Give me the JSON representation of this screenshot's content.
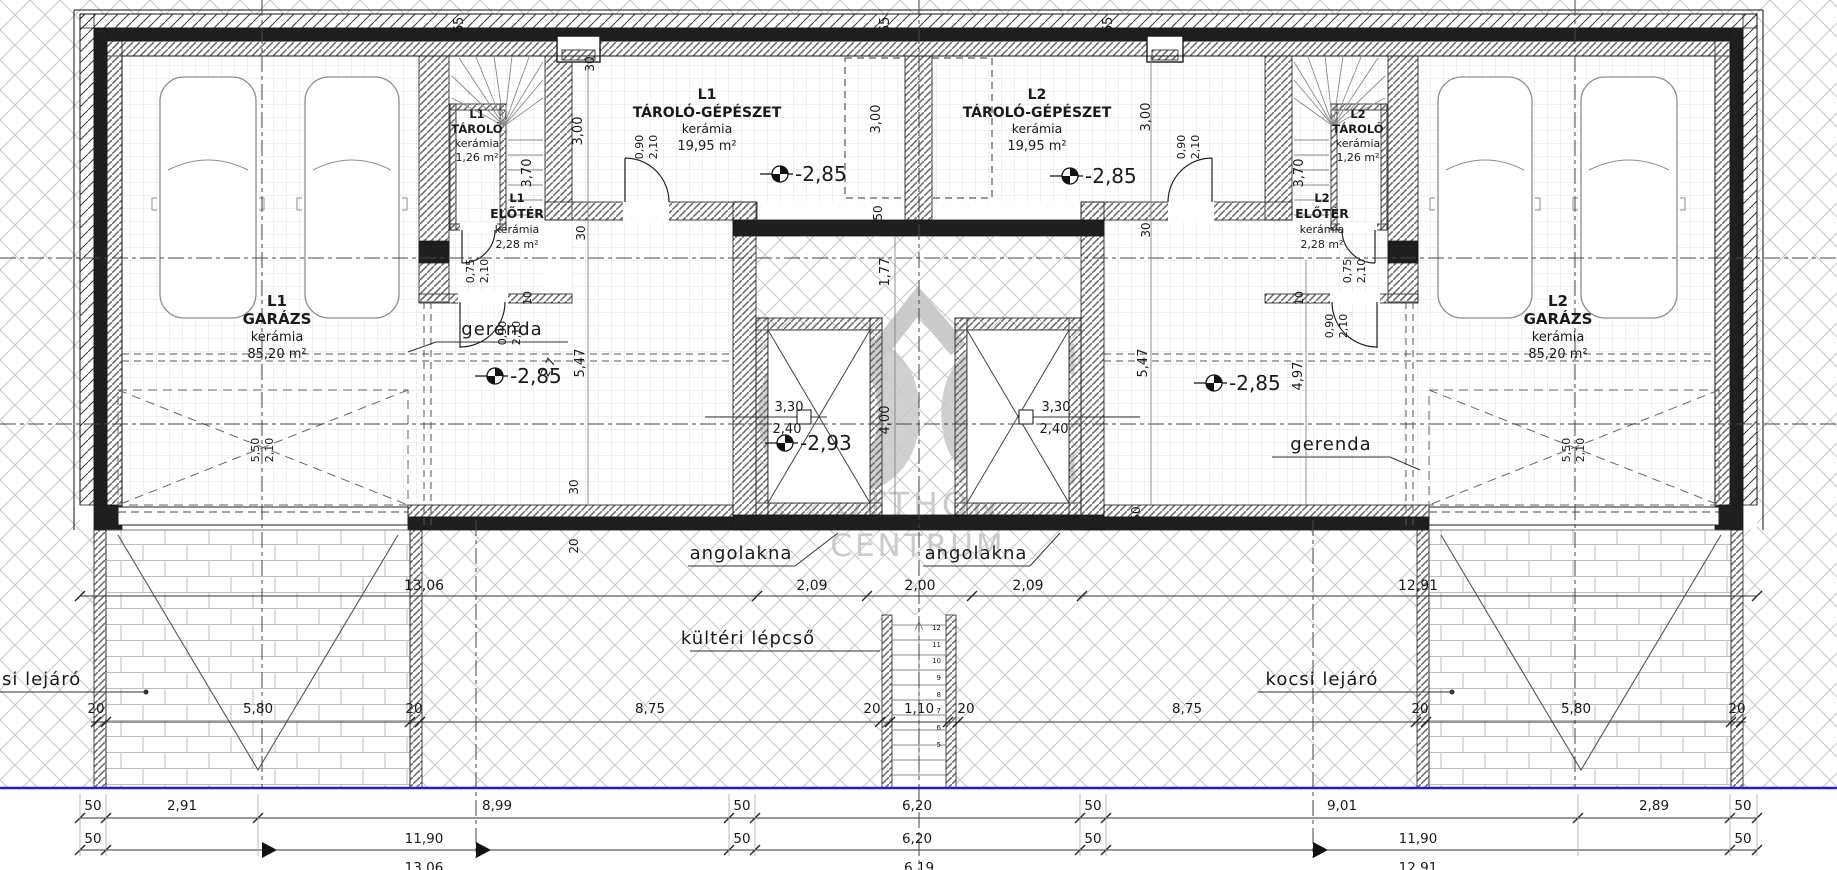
{
  "watermark": {
    "monogram": "OC",
    "word1": "OTTHON",
    "word2": "CENTRUM"
  },
  "texts": [
    {
      "n": "room-l1-garage-code",
      "t": "L1",
      "x": 277,
      "y": 306,
      "s": 15,
      "b": 1
    },
    {
      "n": "room-l1-garage-name",
      "t": "GARÁZS",
      "x": 277,
      "y": 324,
      "s": 15,
      "b": 1
    },
    {
      "n": "room-l1-garage-finish",
      "t": "kerámia",
      "x": 277,
      "y": 341,
      "s": 13
    },
    {
      "n": "room-l1-garage-area",
      "t": "85,20 m²",
      "x": 277,
      "y": 358,
      "s": 13
    },
    {
      "n": "room-l2-garage-code",
      "t": "L2",
      "x": 1558,
      "y": 306,
      "s": 15,
      "b": 1
    },
    {
      "n": "room-l2-garage-name",
      "t": "GARÁZS",
      "x": 1558,
      "y": 324,
      "s": 15,
      "b": 1
    },
    {
      "n": "room-l2-garage-finish",
      "t": "kerámia",
      "x": 1558,
      "y": 341,
      "s": 13
    },
    {
      "n": "room-l2-garage-area",
      "t": "85,20 m²",
      "x": 1558,
      "y": 358,
      "s": 13
    },
    {
      "n": "room-l1-mech-code",
      "t": "L1",
      "x": 707,
      "y": 99,
      "s": 14,
      "b": 1
    },
    {
      "n": "room-l1-mech-name",
      "t": "TÁROLÓ-GÉPÉSZET",
      "x": 707,
      "y": 117,
      "s": 14,
      "b": 1
    },
    {
      "n": "room-l1-mech-finish",
      "t": "kerámia",
      "x": 707,
      "y": 133,
      "s": 12.5
    },
    {
      "n": "room-l1-mech-area",
      "t": "19,95 m²",
      "x": 707,
      "y": 150,
      "s": 13
    },
    {
      "n": "room-l2-mech-code",
      "t": "L2",
      "x": 1037,
      "y": 99,
      "s": 14,
      "b": 1
    },
    {
      "n": "room-l2-mech-name",
      "t": "TÁROLÓ-GÉPÉSZET",
      "x": 1037,
      "y": 117,
      "s": 14,
      "b": 1
    },
    {
      "n": "room-l2-mech-finish",
      "t": "kerámia",
      "x": 1037,
      "y": 133,
      "s": 12.5
    },
    {
      "n": "room-l2-mech-area",
      "t": "19,95 m²",
      "x": 1037,
      "y": 150,
      "s": 13
    },
    {
      "n": "room-l1-storage-code",
      "t": "L1",
      "x": 477,
      "y": 118,
      "s": 11.5,
      "b": 1
    },
    {
      "n": "room-l1-storage-name",
      "t": "TÁROLÓ",
      "x": 477,
      "y": 133,
      "s": 11.5,
      "b": 1
    },
    {
      "n": "room-l1-storage-finish",
      "t": "kerámia",
      "x": 477,
      "y": 147,
      "s": 11
    },
    {
      "n": "room-l1-storage-area",
      "t": "1,26 m²",
      "x": 477,
      "y": 161,
      "s": 11
    },
    {
      "n": "room-l1-hall-code",
      "t": "L1",
      "x": 517,
      "y": 202,
      "s": 11.5,
      "b": 1
    },
    {
      "n": "room-l1-hall-name",
      "t": "ELŐTÉR",
      "x": 517,
      "y": 218,
      "s": 12.5,
      "b": 1
    },
    {
      "n": "room-l1-hall-finish",
      "t": "kerámia",
      "x": 517,
      "y": 233,
      "s": 11
    },
    {
      "n": "room-l1-hall-area",
      "t": "2,28 m²",
      "x": 517,
      "y": 248,
      "s": 11
    },
    {
      "n": "room-l2-storage-code",
      "t": "L2",
      "x": 1358,
      "y": 118,
      "s": 11.5,
      "b": 1
    },
    {
      "n": "room-l2-storage-name",
      "t": "TÁROLÓ",
      "x": 1358,
      "y": 133,
      "s": 11.5,
      "b": 1
    },
    {
      "n": "room-l2-storage-finish",
      "t": "kerámia",
      "x": 1358,
      "y": 147,
      "s": 11
    },
    {
      "n": "room-l2-storage-area",
      "t": "1,26 m²",
      "x": 1358,
      "y": 161,
      "s": 11
    },
    {
      "n": "room-l2-hall-code",
      "t": "L2",
      "x": 1322,
      "y": 202,
      "s": 11.5,
      "b": 1
    },
    {
      "n": "room-l2-hall-name",
      "t": "ELŐTÉR",
      "x": 1322,
      "y": 218,
      "s": 12.5,
      "b": 1
    },
    {
      "n": "room-l2-hall-finish",
      "t": "kerámia",
      "x": 1322,
      "y": 233,
      "s": 11
    },
    {
      "n": "room-l2-hall-area",
      "t": "2,28 m²",
      "x": 1322,
      "y": 248,
      "s": 11
    },
    {
      "n": "level-l1-mech",
      "t": "-2,85",
      "x": 795,
      "y": 181,
      "s": 20,
      "a": "s"
    },
    {
      "n": "level-l2-mech",
      "t": "-2,85",
      "x": 1085,
      "y": 183,
      "s": 20,
      "a": "s"
    },
    {
      "n": "level-l1-garage",
      "t": "-2,85",
      "x": 510,
      "y": 383,
      "s": 20,
      "a": "s"
    },
    {
      "n": "level-l2-garage",
      "t": "-2,85",
      "x": 1229,
      "y": 390,
      "s": 20,
      "a": "s"
    },
    {
      "n": "level-shaft",
      "t": "-2,93",
      "x": 800,
      "y": 450,
      "s": 20,
      "a": "s"
    },
    {
      "n": "note-beam-left",
      "t": "gerenda",
      "x": 502,
      "y": 335,
      "s": 18,
      "ls": 1
    },
    {
      "n": "note-beam-right",
      "t": "gerenda",
      "x": 1331,
      "y": 450,
      "s": 18,
      "ls": 1
    },
    {
      "n": "note-lightwell-left",
      "t": "angolakna",
      "x": 741,
      "y": 559,
      "s": 18,
      "ls": 1
    },
    {
      "n": "note-lightwell-right",
      "t": "angolakna",
      "x": 976,
      "y": 559,
      "s": 18,
      "ls": 1
    },
    {
      "n": "note-outdoor-stair",
      "t": "kültéri lépcső",
      "x": 748,
      "y": 644,
      "s": 18,
      "ls": 1
    },
    {
      "n": "note-car-ramp-left",
      "t": "si lejáró",
      "x": 2,
      "y": 685,
      "s": 18,
      "ls": 1,
      "a": "s"
    },
    {
      "n": "note-car-ramp-right",
      "t": "kocsi lejáró",
      "x": 1322,
      "y": 685,
      "s": 18,
      "ls": 1
    },
    {
      "n": "shaft-left-dim1",
      "t": "3,30",
      "x": 789,
      "y": 411,
      "s": 13
    },
    {
      "n": "shaft-left-dim2",
      "t": "2,40",
      "x": 787,
      "y": 433,
      "s": 13
    },
    {
      "n": "shaft-right-dim1",
      "t": "3,30",
      "x": 1056,
      "y": 411,
      "s": 13
    },
    {
      "n": "shaft-right-dim2",
      "t": "2,40",
      "x": 1054,
      "y": 433,
      "s": 13
    },
    {
      "t": "13,06",
      "x": 424,
      "y": 590,
      "s": 14
    },
    {
      "t": "2,09",
      "x": 812,
      "y": 590,
      "s": 14
    },
    {
      "t": "2,00",
      "x": 920,
      "y": 590,
      "s": 14
    },
    {
      "t": "2,09",
      "x": 1028,
      "y": 590,
      "s": 14
    },
    {
      "t": "12,91",
      "x": 1418,
      "y": 590,
      "s": 14
    },
    {
      "t": "20",
      "x": 96,
      "y": 713,
      "s": 13.5
    },
    {
      "t": "5,80",
      "x": 258,
      "y": 713,
      "s": 13.5
    },
    {
      "t": "20",
      "x": 414,
      "y": 713,
      "s": 13.5
    },
    {
      "t": "8,75",
      "x": 650,
      "y": 713,
      "s": 13.5
    },
    {
      "t": "20",
      "x": 872,
      "y": 713,
      "s": 13.5
    },
    {
      "t": "1,10",
      "x": 919,
      "y": 713,
      "s": 13.5
    },
    {
      "t": "20",
      "x": 966,
      "y": 713,
      "s": 13.5
    },
    {
      "t": "8,75",
      "x": 1187,
      "y": 713,
      "s": 13.5
    },
    {
      "t": "20",
      "x": 1420,
      "y": 713,
      "s": 13.5
    },
    {
      "t": "5,80",
      "x": 1576,
      "y": 713,
      "s": 13.5
    },
    {
      "t": "20",
      "x": 1737,
      "y": 713,
      "s": 13.5
    },
    {
      "t": "50",
      "x": 93,
      "y": 810,
      "s": 13.5
    },
    {
      "t": "2,91",
      "x": 182,
      "y": 810,
      "s": 13.5
    },
    {
      "t": "8,99",
      "x": 497,
      "y": 810,
      "s": 13.5
    },
    {
      "t": "50",
      "x": 742,
      "y": 810,
      "s": 13.5
    },
    {
      "t": "6,20",
      "x": 917,
      "y": 810,
      "s": 13.5
    },
    {
      "t": "50",
      "x": 1093,
      "y": 810,
      "s": 13.5
    },
    {
      "t": "9,01",
      "x": 1342,
      "y": 810,
      "s": 13.5
    },
    {
      "t": "2,89",
      "x": 1654,
      "y": 810,
      "s": 13.5
    },
    {
      "t": "50",
      "x": 1743,
      "y": 810,
      "s": 13.5
    },
    {
      "t": "50",
      "x": 93,
      "y": 843,
      "s": 13.5
    },
    {
      "t": "11,90",
      "x": 424,
      "y": 843,
      "s": 13.5
    },
    {
      "t": "50",
      "x": 742,
      "y": 843,
      "s": 13.5
    },
    {
      "t": "6,20",
      "x": 917,
      "y": 843,
      "s": 13.5
    },
    {
      "t": "50",
      "x": 1093,
      "y": 843,
      "s": 13.5
    },
    {
      "t": "11,90",
      "x": 1418,
      "y": 843,
      "s": 13.5
    },
    {
      "t": "50",
      "x": 1743,
      "y": 843,
      "s": 13.5
    },
    {
      "t": "13,06",
      "x": 424,
      "y": 872,
      "s": 13.5
    },
    {
      "t": "6,19",
      "x": 919,
      "y": 872,
      "s": 13.5
    },
    {
      "t": "12,91",
      "x": 1418,
      "y": 872,
      "s": 13.5
    },
    {
      "t": "65",
      "x": 463,
      "y": 25,
      "s": 13,
      "r": -90
    },
    {
      "t": "65",
      "x": 889,
      "y": 25,
      "s": 13,
      "r": -90
    },
    {
      "t": "65",
      "x": 1112,
      "y": 25,
      "s": 13,
      "r": -90
    },
    {
      "t": "30",
      "x": 594,
      "y": 64,
      "s": 12,
      "r": -90
    },
    {
      "t": "30",
      "x": 585,
      "y": 233,
      "s": 12,
      "r": -90
    },
    {
      "t": "30",
      "x": 1150,
      "y": 230,
      "s": 12,
      "r": -90
    },
    {
      "t": "30",
      "x": 578,
      "y": 487,
      "s": 12,
      "r": -90
    },
    {
      "t": "3,00",
      "x": 582,
      "y": 131,
      "s": 13,
      "r": -90
    },
    {
      "t": "3,00",
      "x": 880,
      "y": 119,
      "s": 13,
      "r": -90
    },
    {
      "t": "3,00",
      "x": 1150,
      "y": 117,
      "s": 13,
      "r": -90
    },
    {
      "t": "3,70",
      "x": 531,
      "y": 173,
      "s": 13,
      "r": -90
    },
    {
      "t": "3,70",
      "x": 1303,
      "y": 173,
      "s": 13,
      "r": -90
    },
    {
      "t": "50",
      "x": 882,
      "y": 213,
      "s": 12,
      "r": -90
    },
    {
      "t": "50",
      "x": 1140,
      "y": 514,
      "s": 12,
      "r": -90
    },
    {
      "t": "20",
      "x": 578,
      "y": 546,
      "s": 12,
      "r": -90
    },
    {
      "t": "10",
      "x": 531,
      "y": 298,
      "s": 11,
      "r": -90
    },
    {
      "t": "10",
      "x": 1303,
      "y": 298,
      "s": 11,
      "r": -90
    },
    {
      "t": "1,77",
      "x": 889,
      "y": 272,
      "s": 13,
      "r": -90
    },
    {
      "t": "4,00",
      "x": 889,
      "y": 420,
      "s": 13,
      "r": -90
    },
    {
      "t": "5,47",
      "x": 584,
      "y": 363,
      "s": 13,
      "r": -90
    },
    {
      "t": "5,47",
      "x": 1147,
      "y": 363,
      "s": 13,
      "r": -90
    },
    {
      "t": "4,97",
      "x": 1302,
      "y": 376,
      "s": 13,
      "r": -90
    },
    {
      "t": "2,7",
      "x": 552,
      "y": 369,
      "s": 12,
      "r": -65
    },
    {
      "t": "0,90",
      "x": 643,
      "y": 147,
      "s": 11,
      "r": -90
    },
    {
      "t": "2,10",
      "x": 657,
      "y": 147,
      "s": 11,
      "r": -90
    },
    {
      "t": "0,90",
      "x": 1185,
      "y": 147,
      "s": 11,
      "r": -90
    },
    {
      "t": "2,10",
      "x": 1199,
      "y": 147,
      "s": 11,
      "r": -90
    },
    {
      "t": "0,90",
      "x": 506,
      "y": 333,
      "s": 11,
      "r": -90
    },
    {
      "t": "2,10",
      "x": 520,
      "y": 333,
      "s": 11,
      "r": -90
    },
    {
      "t": "0,90",
      "x": 1333,
      "y": 326,
      "s": 11,
      "r": -90
    },
    {
      "t": "2,10",
      "x": 1347,
      "y": 326,
      "s": 11,
      "r": -90
    },
    {
      "t": "0,75",
      "x": 474,
      "y": 271,
      "s": 11,
      "r": -90
    },
    {
      "t": "2,10",
      "x": 488,
      "y": 271,
      "s": 11,
      "r": -90
    },
    {
      "t": "0,75",
      "x": 1351,
      "y": 271,
      "s": 11,
      "r": -90
    },
    {
      "t": "2,10",
      "x": 1365,
      "y": 271,
      "s": 11,
      "r": -90
    },
    {
      "t": "5,50",
      "x": 259,
      "y": 450,
      "s": 11,
      "r": -90
    },
    {
      "t": "2,10",
      "x": 273,
      "y": 450,
      "s": 11,
      "r": -90
    },
    {
      "t": "5,50",
      "x": 1570,
      "y": 450,
      "s": 11,
      "r": -90
    },
    {
      "t": "2,10",
      "x": 1584,
      "y": 450,
      "s": 11,
      "r": -90
    },
    {
      "n": "step-no",
      "t": "12",
      "x": 941,
      "y": 630,
      "s": 7,
      "a": "e"
    },
    {
      "n": "step-no",
      "t": "11",
      "x": 941,
      "y": 647,
      "s": 7,
      "a": "e"
    },
    {
      "n": "step-no",
      "t": "10",
      "x": 941,
      "y": 663,
      "s": 7,
      "a": "e"
    },
    {
      "n": "step-no",
      "t": "9",
      "x": 941,
      "y": 680,
      "s": 7,
      "a": "e"
    },
    {
      "n": "step-no",
      "t": "8",
      "x": 941,
      "y": 697,
      "s": 7,
      "a": "e"
    },
    {
      "n": "step-no",
      "t": "7",
      "x": 941,
      "y": 713,
      "s": 7,
      "a": "e"
    },
    {
      "n": "step-no",
      "t": "6",
      "x": 941,
      "y": 730,
      "s": 7,
      "a": "e"
    },
    {
      "n": "step-no",
      "t": "5",
      "x": 941,
      "y": 747,
      "s": 7,
      "a": "e"
    }
  ]
}
